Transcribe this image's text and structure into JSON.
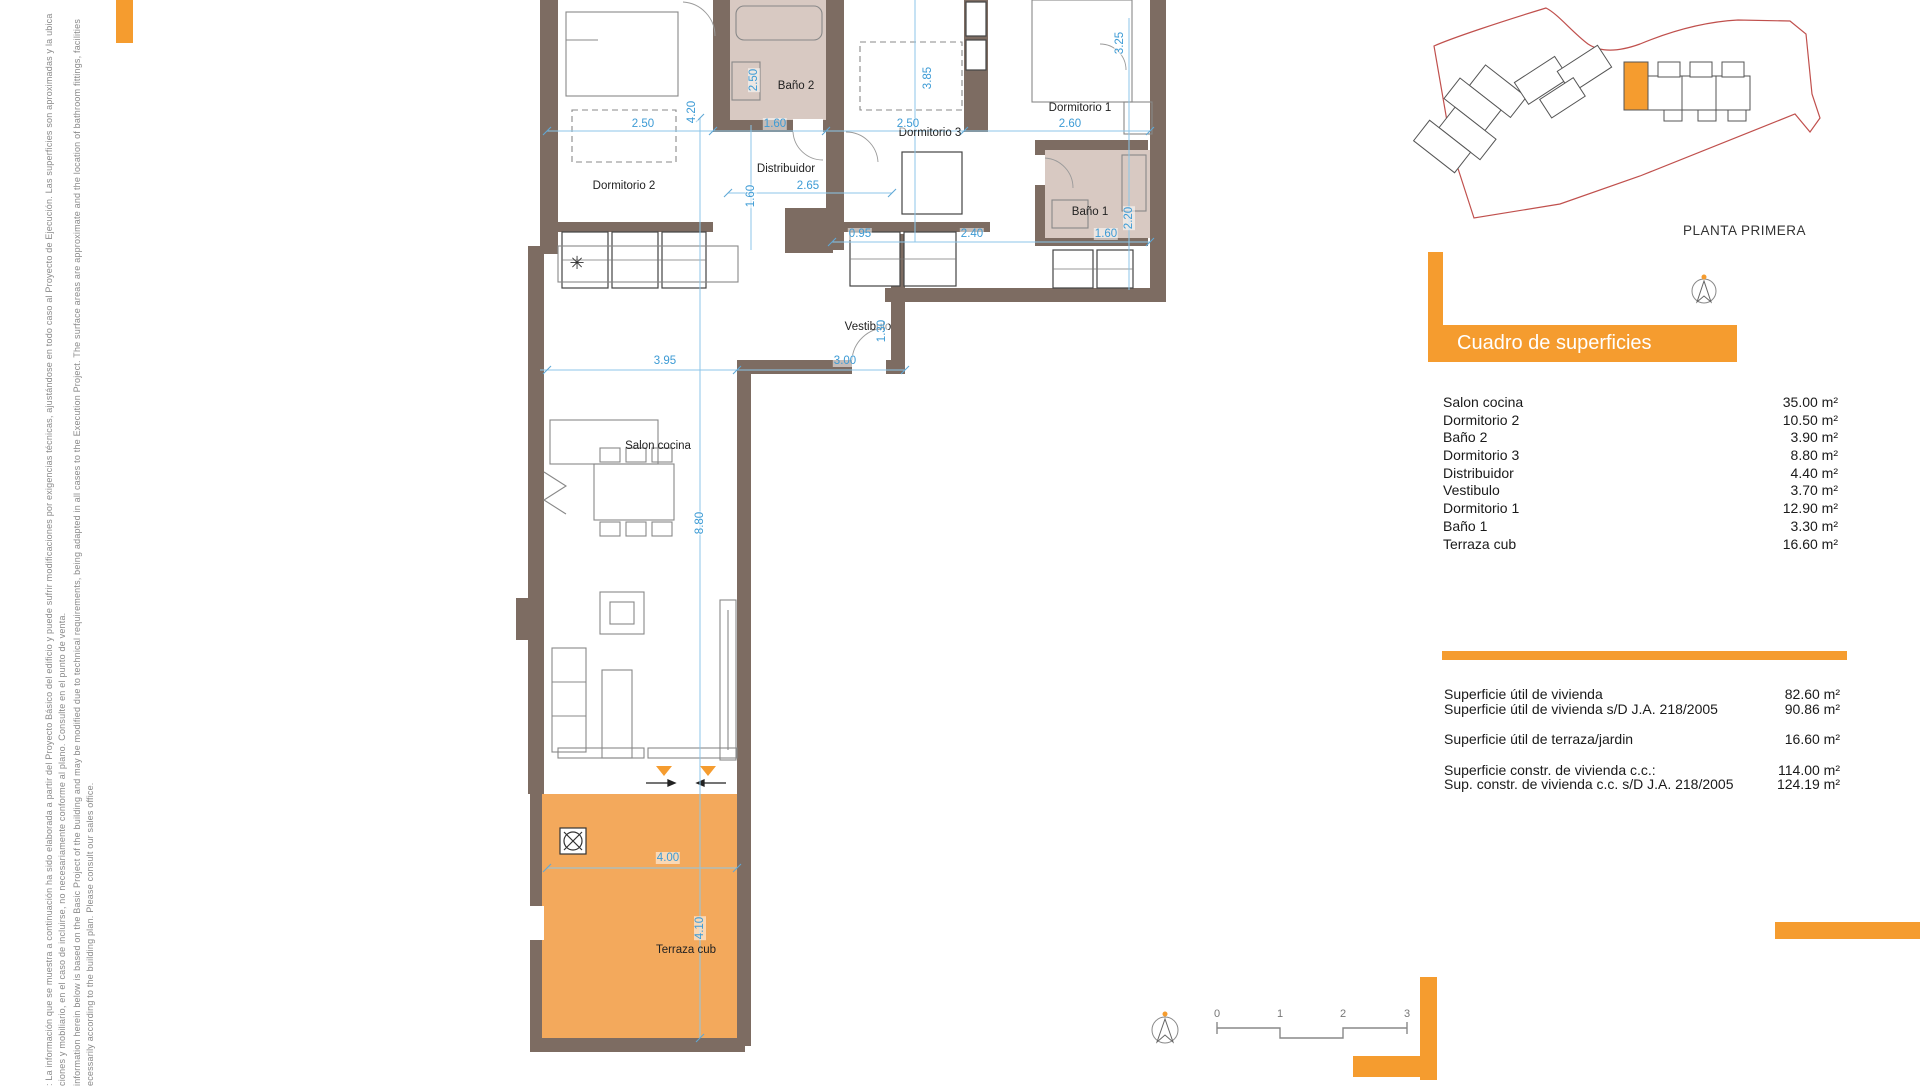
{
  "colors": {
    "accent_orange": "#F59C2F",
    "terrace_fill": "#F3A95C",
    "wall_fill": "#7D6C62",
    "bath_fill": "#D8C9C2",
    "dimension_blue": "#3D9BD5",
    "site_boundary_red": "#C0504D"
  },
  "disclaimer": {
    "lines": [
      ": La información que se muestra a continuación ha sido elaborada a partir del Proyecto Básico del edificio y puede sufrir modificaciones por exigencias técnicas, ajustándose en todo caso al Proyecto de Ejecución. Las superficies son aproximadas y la ubica",
      "ciones y mobiliario, en el caso de incluirse, no necesariamente conforme al plano. Consulte en el punto de venta.",
      "information herein below is based on the Basic Project of the building and may be modified due to technical requirements, being adapted in all cases to the Execution Project. The surface areas are approximate and the location of bathroom fittings, facilities",
      "ecessarily according to the building plan. Please consult our sales office."
    ]
  },
  "plan": {
    "rooms": [
      {
        "label": "Dormitorio 2",
        "x": 624,
        "y": 186
      },
      {
        "label": "Baño 2",
        "x": 796,
        "y": 86
      },
      {
        "label": "Dormitorio 3",
        "x": 930,
        "y": 133
      },
      {
        "label": "Dormitorio 1",
        "x": 1080,
        "y": 108
      },
      {
        "label": "Distribuidor",
        "x": 786,
        "y": 169
      },
      {
        "label": "Baño 1",
        "x": 1090,
        "y": 212
      },
      {
        "label": "Vestibulo",
        "x": 868,
        "y": 327
      },
      {
        "label": "Salon cocina",
        "x": 658,
        "y": 446
      },
      {
        "label": "Terraza cub",
        "x": 686,
        "y": 950
      }
    ],
    "dimensions": [
      {
        "text": "2.50",
        "x": 643,
        "y": 124,
        "rotated": false
      },
      {
        "text": "1.60",
        "x": 775,
        "y": 124,
        "rotated": false
      },
      {
        "text": "2.50",
        "x": 908,
        "y": 124,
        "rotated": false
      },
      {
        "text": "2.60",
        "x": 1070,
        "y": 124,
        "rotated": false
      },
      {
        "text": "4.20",
        "x": 692,
        "y": 112,
        "rotated": true
      },
      {
        "text": "2.50",
        "x": 754,
        "y": 80,
        "rotated": true
      },
      {
        "text": "3.85",
        "x": 928,
        "y": 78,
        "rotated": true
      },
      {
        "text": "3.25",
        "x": 1120,
        "y": 43,
        "rotated": true
      },
      {
        "text": "2.65",
        "x": 808,
        "y": 186,
        "rotated": false
      },
      {
        "text": "1.60",
        "x": 751,
        "y": 196,
        "rotated": true
      },
      {
        "text": "0.95",
        "x": 860,
        "y": 234,
        "rotated": false
      },
      {
        "text": "2.40",
        "x": 972,
        "y": 234,
        "rotated": false
      },
      {
        "text": "1.60",
        "x": 1106,
        "y": 234,
        "rotated": false
      },
      {
        "text": "2.20",
        "x": 1129,
        "y": 218,
        "rotated": true
      },
      {
        "text": "3.95",
        "x": 665,
        "y": 361,
        "rotated": false
      },
      {
        "text": "3.00",
        "x": 845,
        "y": 361,
        "rotated": false
      },
      {
        "text": "1.30",
        "x": 882,
        "y": 331,
        "rotated": true
      },
      {
        "text": "8.80",
        "x": 700,
        "y": 523,
        "rotated": true
      },
      {
        "text": "4.00",
        "x": 668,
        "y": 858,
        "rotated": false
      },
      {
        "text": "4.10",
        "x": 700,
        "y": 928,
        "rotated": true
      }
    ]
  },
  "site_plan": {
    "title": "PLANTA PRIMERA"
  },
  "surface_table": {
    "title": "Cuadro de superficies",
    "rows": [
      {
        "label": "Salon cocina",
        "value": "35.00 m²"
      },
      {
        "label": "Dormitorio 2",
        "value": "10.50 m²"
      },
      {
        "label": "Baño 2",
        "value": "3.90 m²"
      },
      {
        "label": "Dormitorio 3",
        "value": "8.80 m²"
      },
      {
        "label": "Distribuidor",
        "value": "4.40 m²"
      },
      {
        "label": "Vestibulo",
        "value": "3.70 m²"
      },
      {
        "label": "Dormitorio 1",
        "value": "12.90 m²"
      },
      {
        "label": "Baño 1",
        "value": "3.30 m²"
      },
      {
        "label": "Terraza cub",
        "value": "16.60 m²"
      }
    ]
  },
  "summary": {
    "rows": [
      {
        "label": "Superficie útil de vivienda",
        "value": "82.60 m²",
        "gap_before": false
      },
      {
        "label": "Superficie útil de vivienda s/D J.A. 218/2005",
        "value": "90.86 m²",
        "gap_before": false
      },
      {
        "label": "Superficie útil de terraza/jardin",
        "value": "16.60 m²",
        "gap_before": true
      },
      {
        "label": "Superficie constr. de vivienda c.c.:",
        "value": "114.00 m²",
        "gap_before": true
      },
      {
        "label": "Sup. constr. de vivienda c.c. s/D J.A. 218/2005",
        "value": "124.19 m²",
        "gap_before": false
      }
    ]
  },
  "scale_bar": {
    "labels": [
      {
        "text": "0",
        "x": 1217
      },
      {
        "text": "1",
        "x": 1280
      },
      {
        "text": "2",
        "x": 1343
      },
      {
        "text": "3",
        "x": 1407
      }
    ]
  },
  "icons": {
    "kitchen_appliance": "✳"
  }
}
